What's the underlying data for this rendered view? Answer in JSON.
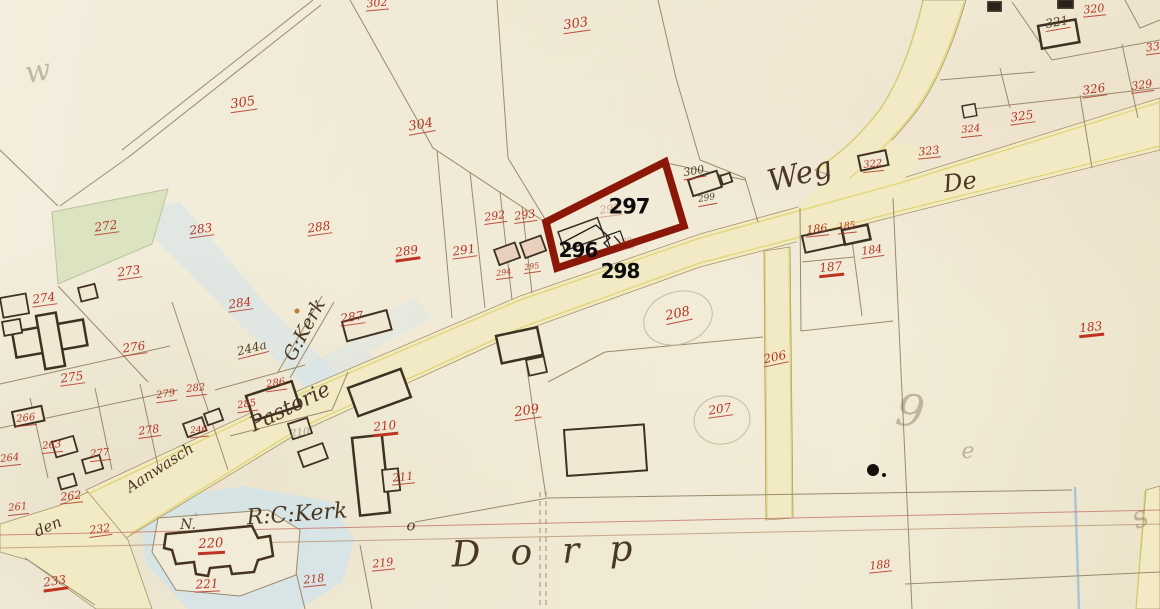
{
  "map": {
    "colors": {
      "paper": "#f1ebda",
      "red_ink": "#b43425",
      "sepia_ink": "#54422c",
      "pencil": "#a89a82",
      "water": "#d4e4eb",
      "green_parcel": "#dbe3c1",
      "road_fill": "#f2eac5",
      "road_edge_yellow": "#ddd36a",
      "parcel_line": "#9a8a6c",
      "highlight": "#8b1708",
      "overlay_text": "#0d0d0d"
    },
    "overlay": {
      "highlight_color": "#8b1708",
      "labels": [
        {
          "text": "297",
          "x": 629,
          "y": 207,
          "s": 21
        },
        {
          "text": "296",
          "x": 578,
          "y": 250,
          "s": 20
        },
        {
          "text": "298",
          "x": 620,
          "y": 271,
          "s": 20
        }
      ]
    },
    "parcel_numbers": [
      {
        "text": "305",
        "x": 243,
        "y": 104,
        "r": -8,
        "s": 13
      },
      {
        "text": "304",
        "x": 421,
        "y": 126,
        "r": -10,
        "s": 13
      },
      {
        "text": "303",
        "x": 576,
        "y": 25,
        "r": -8,
        "s": 13
      },
      {
        "text": "302",
        "x": 377,
        "y": 4,
        "r": -5,
        "s": 11
      },
      {
        "text": "320",
        "x": 1094,
        "y": 10,
        "r": -6,
        "s": 11
      },
      {
        "text": "321",
        "x": 1057,
        "y": 23,
        "r": -10,
        "s": 12,
        "cls": "sepia u-red"
      },
      {
        "text": "326",
        "x": 1094,
        "y": 90,
        "r": -8,
        "s": 12
      },
      {
        "text": "329",
        "x": 1142,
        "y": 86,
        "r": -8,
        "s": 11
      },
      {
        "text": "33",
        "x": 1153,
        "y": 48,
        "r": -8,
        "s": 11
      },
      {
        "text": "325",
        "x": 1022,
        "y": 117,
        "r": -8,
        "s": 12
      },
      {
        "text": "324",
        "x": 971,
        "y": 131,
        "r": -6,
        "s": 10
      },
      {
        "text": "323",
        "x": 929,
        "y": 152,
        "r": -6,
        "s": 11
      },
      {
        "text": "322",
        "x": 873,
        "y": 166,
        "r": -6,
        "s": 10
      },
      {
        "text": "186",
        "x": 817,
        "y": 230,
        "r": -6,
        "s": 11
      },
      {
        "text": "185",
        "x": 847,
        "y": 228,
        "r": -6,
        "s": 9
      },
      {
        "text": "184",
        "x": 872,
        "y": 251,
        "r": -8,
        "s": 11
      },
      {
        "text": "187",
        "x": 831,
        "y": 269,
        "r": -6,
        "s": 12,
        "cls": "thick"
      },
      {
        "text": "183",
        "x": 1091,
        "y": 329,
        "r": -6,
        "s": 12,
        "cls": "thick"
      },
      {
        "text": "188",
        "x": 880,
        "y": 566,
        "r": -6,
        "s": 11
      },
      {
        "text": "272",
        "x": 106,
        "y": 227,
        "r": -8,
        "s": 12
      },
      {
        "text": "283",
        "x": 201,
        "y": 230,
        "r": -8,
        "s": 12
      },
      {
        "text": "273",
        "x": 129,
        "y": 272,
        "r": -8,
        "s": 12
      },
      {
        "text": "284",
        "x": 240,
        "y": 304,
        "r": -8,
        "s": 12
      },
      {
        "text": "288",
        "x": 319,
        "y": 228,
        "r": -8,
        "s": 12
      },
      {
        "text": "289",
        "x": 407,
        "y": 253,
        "r": -8,
        "s": 12,
        "cls": "thick"
      },
      {
        "text": "291",
        "x": 464,
        "y": 251,
        "r": -8,
        "s": 12
      },
      {
        "text": "292",
        "x": 495,
        "y": 217,
        "r": -8,
        "s": 11
      },
      {
        "text": "293",
        "x": 525,
        "y": 216,
        "r": -8,
        "s": 11
      },
      {
        "text": "294",
        "x": 504,
        "y": 274,
        "r": -8,
        "s": 8
      },
      {
        "text": "295",
        "x": 532,
        "y": 268,
        "r": -8,
        "s": 8
      },
      {
        "text": "300",
        "x": 694,
        "y": 172,
        "r": -10,
        "s": 11,
        "cls": "sepia u-red"
      },
      {
        "text": "299",
        "x": 707,
        "y": 200,
        "r": -10,
        "s": 9,
        "cls": "sepia u-red"
      },
      {
        "text": "297",
        "x": 610,
        "y": 210,
        "r": -8,
        "s": 11,
        "cls": "faint"
      },
      {
        "text": "298",
        "x": 624,
        "y": 244,
        "r": -8,
        "s": 9,
        "cls": "faint"
      },
      {
        "text": "274",
        "x": 44,
        "y": 299,
        "r": -8,
        "s": 12
      },
      {
        "text": "276",
        "x": 134,
        "y": 348,
        "r": -8,
        "s": 12
      },
      {
        "text": "275",
        "x": 72,
        "y": 378,
        "r": -8,
        "s": 12
      },
      {
        "text": "266",
        "x": 26,
        "y": 420,
        "r": -6,
        "s": 10
      },
      {
        "text": "264",
        "x": 10,
        "y": 460,
        "r": -6,
        "s": 10
      },
      {
        "text": "263",
        "x": 52,
        "y": 447,
        "r": -6,
        "s": 10
      },
      {
        "text": "277",
        "x": 100,
        "y": 455,
        "r": -6,
        "s": 10
      },
      {
        "text": "278",
        "x": 149,
        "y": 431,
        "r": -8,
        "s": 11
      },
      {
        "text": "279",
        "x": 166,
        "y": 396,
        "r": -8,
        "s": 10
      },
      {
        "text": "282",
        "x": 196,
        "y": 390,
        "r": -6,
        "s": 10
      },
      {
        "text": "285",
        "x": 247,
        "y": 406,
        "r": -8,
        "s": 10
      },
      {
        "text": "286",
        "x": 276,
        "y": 385,
        "r": -8,
        "s": 10
      },
      {
        "text": "287",
        "x": 352,
        "y": 318,
        "r": -8,
        "s": 12
      },
      {
        "text": "244a",
        "x": 252,
        "y": 349,
        "r": -14,
        "s": 12,
        "cls": "sepia"
      },
      {
        "text": "246",
        "x": 199,
        "y": 432,
        "r": -6,
        "s": 9
      },
      {
        "text": "210",
        "x": 300,
        "y": 434,
        "r": -6,
        "s": 10,
        "cls": "pencil"
      },
      {
        "text": "210",
        "x": 385,
        "y": 428,
        "r": -6,
        "s": 12,
        "cls": "thick"
      },
      {
        "text": "211",
        "x": 403,
        "y": 478,
        "r": -6,
        "s": 11
      },
      {
        "text": "209",
        "x": 527,
        "y": 412,
        "r": -8,
        "s": 13
      },
      {
        "text": "208",
        "x": 678,
        "y": 315,
        "r": -12,
        "s": 13
      },
      {
        "text": "206",
        "x": 775,
        "y": 358,
        "r": -12,
        "s": 12
      },
      {
        "text": "207",
        "x": 720,
        "y": 410,
        "r": -8,
        "s": 12
      },
      {
        "text": "232",
        "x": 100,
        "y": 530,
        "r": -8,
        "s": 11
      },
      {
        "text": "233",
        "x": 55,
        "y": 583,
        "r": -8,
        "s": 12,
        "cls": "thick"
      },
      {
        "text": "220",
        "x": 211,
        "y": 546,
        "r": -3,
        "s": 13,
        "cls": "thick"
      },
      {
        "text": "221",
        "x": 207,
        "y": 585,
        "r": -3,
        "s": 12
      },
      {
        "text": "218",
        "x": 314,
        "y": 580,
        "r": -6,
        "s": 11
      },
      {
        "text": "219",
        "x": 383,
        "y": 564,
        "r": -6,
        "s": 11
      },
      {
        "text": "261",
        "x": 18,
        "y": 509,
        "r": -6,
        "s": 10
      },
      {
        "text": "262",
        "x": 71,
        "y": 497,
        "r": -6,
        "s": 11
      }
    ],
    "place_names": [
      {
        "text": "Weg",
        "x": 800,
        "y": 175,
        "r": -14,
        "s": 30
      },
      {
        "text": "De",
        "x": 960,
        "y": 182,
        "r": -8,
        "s": 24
      },
      {
        "text": "G:Kerk",
        "x": 305,
        "y": 330,
        "r": -62,
        "s": 19
      },
      {
        "text": "Pastorie",
        "x": 290,
        "y": 407,
        "r": -26,
        "s": 21
      },
      {
        "text": "Aanwasch",
        "x": 160,
        "y": 468,
        "r": -33,
        "s": 15
      },
      {
        "text": "den",
        "x": 48,
        "y": 527,
        "r": -24,
        "s": 15
      },
      {
        "text": "R:C:Kerk",
        "x": 297,
        "y": 515,
        "r": -4,
        "s": 22
      },
      {
        "text": "N.",
        "x": 188,
        "y": 525,
        "r": 0,
        "s": 14
      },
      {
        "text": "o",
        "x": 411,
        "y": 526,
        "r": 0,
        "s": 15
      },
      {
        "text": "Dorp",
        "x": 557,
        "y": 552,
        "r": -2,
        "s": 36,
        "ls": 30
      }
    ],
    "pencil_marks": [
      {
        "text": "w",
        "x": 38,
        "y": 72,
        "r": -10,
        "s": 30
      },
      {
        "text": "9",
        "x": 910,
        "y": 412,
        "r": 8,
        "s": 44
      },
      {
        "text": "e",
        "x": 968,
        "y": 452,
        "r": 0,
        "s": 22
      },
      {
        "text": "s",
        "x": 1140,
        "y": 518,
        "r": -25,
        "s": 30
      },
      {
        "text": "+",
        "x": 196,
        "y": 516,
        "r": 0,
        "s": 9
      }
    ]
  }
}
